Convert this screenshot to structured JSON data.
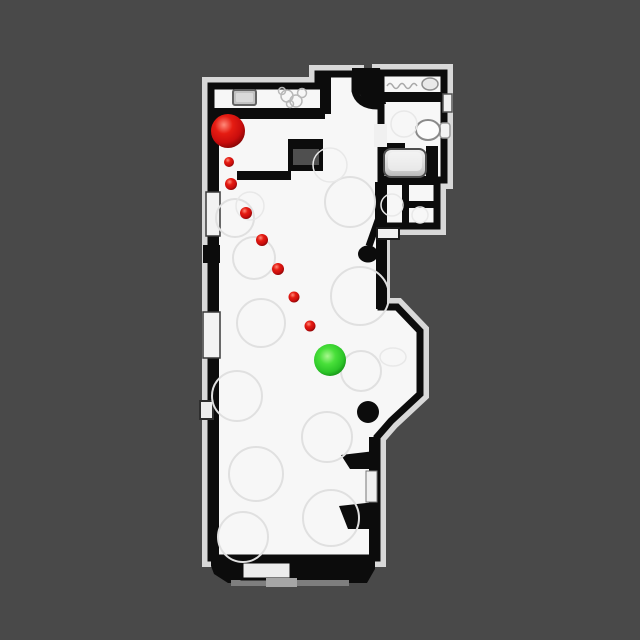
{
  "scene": {
    "background_color": "#494949",
    "floor_color": "#f7f7f7",
    "wall_color": "#0c0c0c",
    "halo_color": "#d8d8d8"
  },
  "markers": {
    "red_sphere": {
      "cx": 228,
      "cy": 131,
      "r": 17
    },
    "red_dot_trail": [
      {
        "cx": 229,
        "cy": 162,
        "r": 5
      },
      {
        "cx": 231,
        "cy": 184,
        "r": 6
      },
      {
        "cx": 246,
        "cy": 213,
        "r": 6
      },
      {
        "cx": 262,
        "cy": 240,
        "r": 6
      },
      {
        "cx": 278,
        "cy": 269,
        "r": 6
      },
      {
        "cx": 294,
        "cy": 297,
        "r": 5.5
      },
      {
        "cx": 310,
        "cy": 326,
        "r": 5.5
      }
    ],
    "green_sphere": {
      "cx": 330,
      "cy": 360,
      "r": 16
    },
    "red_color": "#dc1010",
    "green_color": "#2fd028",
    "red_gradient": [
      "#ff8a7a",
      "#e51c12",
      "#c90d0d",
      "#7a0404"
    ],
    "green_gradient": [
      "#a8f78e",
      "#49e03a",
      "#2cc528",
      "#0e7c10"
    ]
  }
}
